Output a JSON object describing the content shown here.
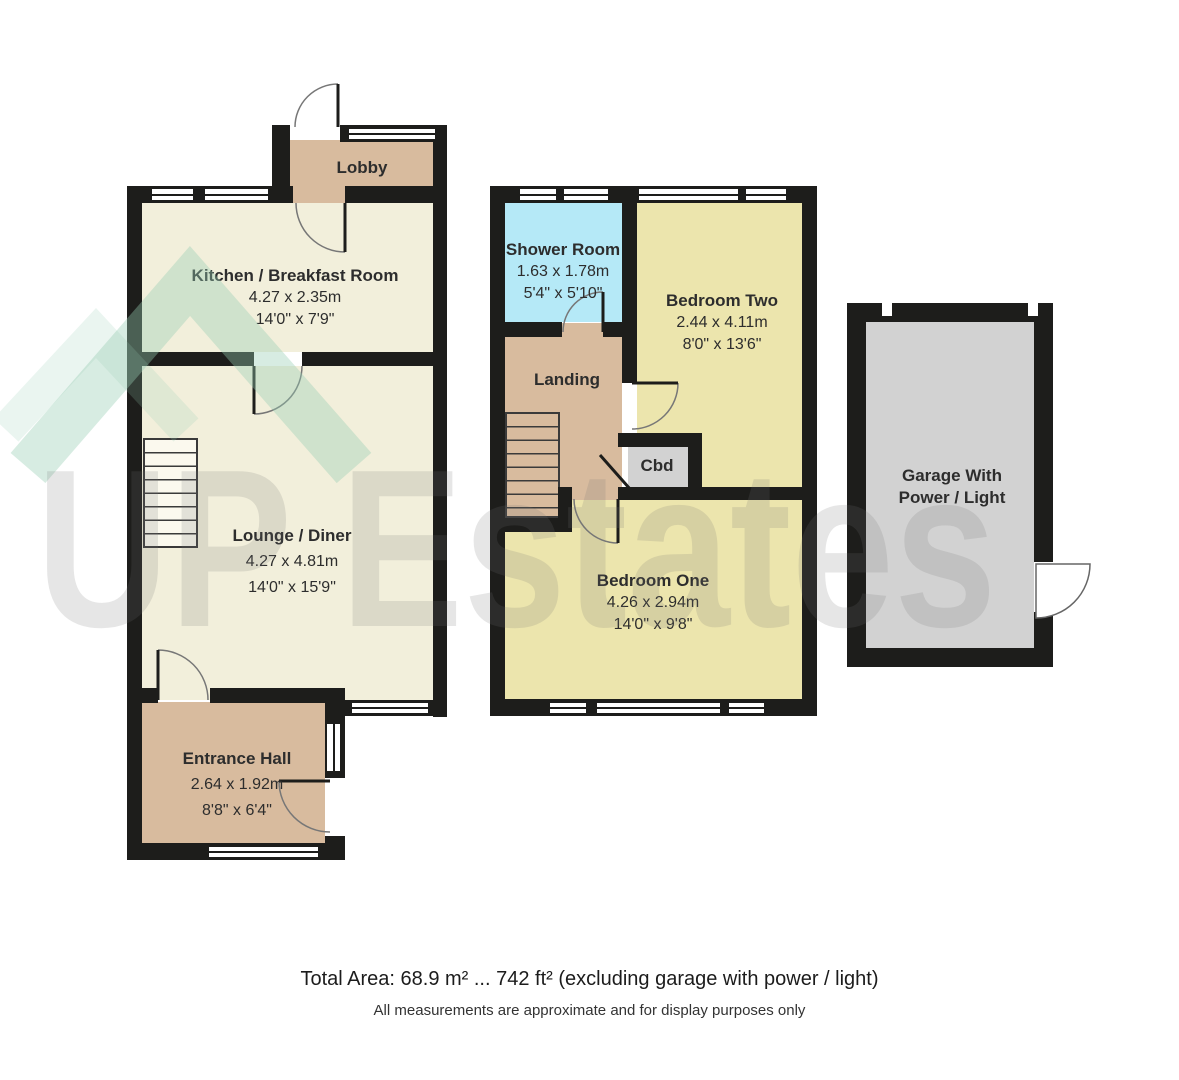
{
  "rooms": {
    "lobby": {
      "name": "Lobby"
    },
    "kitchen": {
      "name": "Kitchen / Breakfast Room",
      "metric": "4.27 x 2.35m",
      "imperial": "14'0\" x 7'9\""
    },
    "lounge": {
      "name": "Lounge / Diner",
      "metric": "4.27 x 4.81m",
      "imperial": "14'0\" x 15'9\""
    },
    "entrance": {
      "name": "Entrance Hall",
      "metric": "2.64 x 1.92m",
      "imperial": "8'8\" x 6'4\""
    },
    "shower": {
      "name": "Shower Room",
      "metric": "1.63 x 1.78m",
      "imperial": "5'4\" x 5'10\""
    },
    "bedroom_two": {
      "name": "Bedroom Two",
      "metric": "2.44 x 4.11m",
      "imperial": "8'0\" x 13'6\""
    },
    "landing": {
      "name": "Landing"
    },
    "cbd": {
      "name": "Cbd"
    },
    "bedroom_one": {
      "name": "Bedroom One",
      "metric": "4.26 x 2.94m",
      "imperial": "14'0\" x 9'8\""
    },
    "garage": {
      "name_line1": "Garage With",
      "name_line2": "Power / Light"
    }
  },
  "watermark": {
    "text": "UP Estates"
  },
  "footer": {
    "total_area": "Total Area: 68.9 m² ... 742 ft² (excluding garage with power / light)",
    "disclaimer": "All measurements are approximate and for display purposes only"
  },
  "colors": {
    "wall": "#1d1d1b",
    "room_cream": "#f2efdb",
    "room_tan": "#d8bb9e",
    "room_yellow": "#ece5ad",
    "room_blue": "#b5e9f7",
    "room_gray": "#d2d2d2",
    "watermark_green": "#9ccdb2",
    "watermark_gray": "#e2e2e2"
  }
}
